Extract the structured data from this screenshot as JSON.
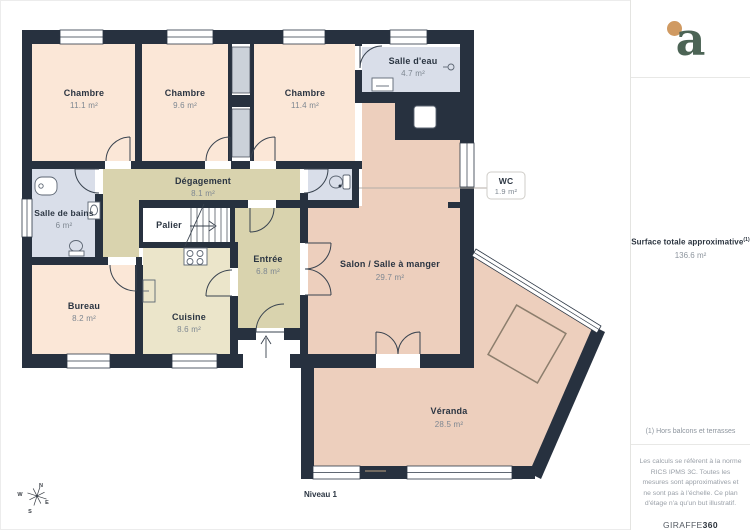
{
  "plan": {
    "level_label": "Niveau 1",
    "compass": {
      "n": "N",
      "e": "E",
      "s": "S",
      "w": "W"
    },
    "rooms": [
      {
        "name": "Chambre",
        "area": "11.1 m²"
      },
      {
        "name": "Chambre",
        "area": "9.6 m²"
      },
      {
        "name": "Chambre",
        "area": "11.4 m²"
      },
      {
        "name": "Salle d'eau",
        "area": "4.7 m²"
      },
      {
        "name": "WC",
        "area": "1.9 m²"
      },
      {
        "name": "Dégagement",
        "area": "8.1 m²"
      },
      {
        "name": "Salle de bains",
        "area": "6 m²"
      },
      {
        "name": "Palier",
        "area": ""
      },
      {
        "name": "Entrée",
        "area": "6.8 m²"
      },
      {
        "name": "Salon / Salle à manger",
        "area": "29.7 m²"
      },
      {
        "name": "Bureau",
        "area": "8.2 m²"
      },
      {
        "name": "Cuisine",
        "area": "8.6 m²"
      },
      {
        "name": "Véranda",
        "area": "28.5 m²"
      }
    ]
  },
  "sidebar": {
    "logo_letter": "a",
    "surface_title": "Surface totale approximative",
    "surface_note_ref": "(1)",
    "surface_value": "136.6 m²",
    "footnote": "(1) Hors balcons et terrasses",
    "disclaimer": "Les calculs se réfèrent à la norme RICS IPMS 3C. Toutes les mesures sont approximatives et ne sont pas à l'échelle. Ce plan d'étage n'a qu'un but illustratif.",
    "brand": {
      "name": "GIRAFFE",
      "suffix": "360"
    }
  },
  "colors": {
    "wall": "#27313F",
    "bedroom_fill": "#FBE7D7",
    "living_fill": "#EDCFBD",
    "circulation_fill": "#D9D3AE",
    "kitchen_fill": "#EBE5CA",
    "bathroom_fill": "#D9DEE9",
    "logo_green": "#4C6455",
    "logo_dot_orange": "#D09A62"
  }
}
